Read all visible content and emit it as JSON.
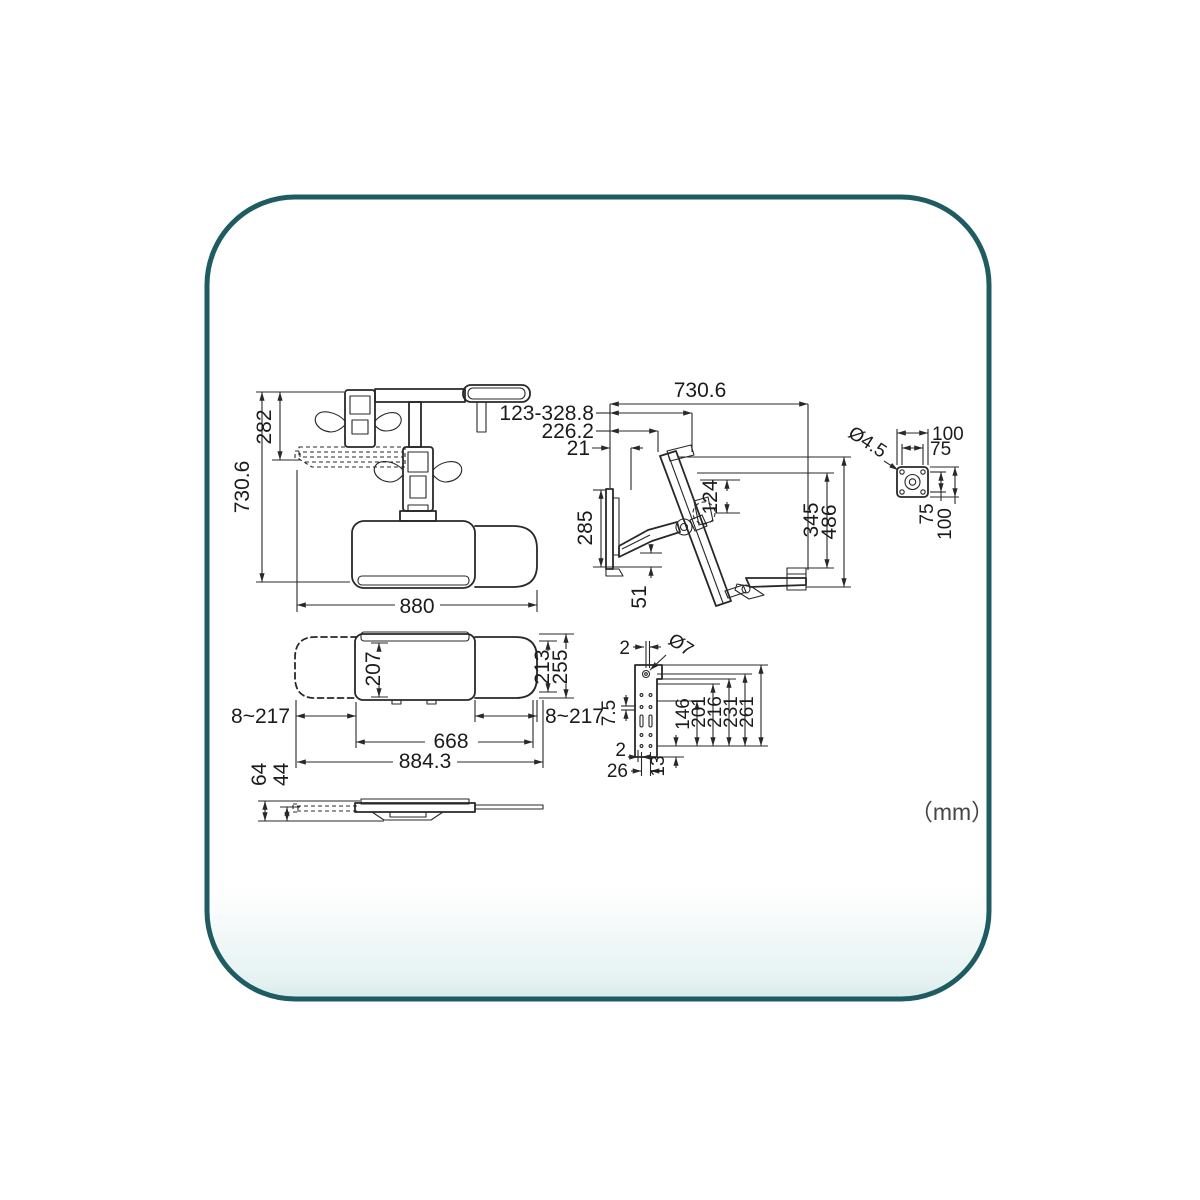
{
  "page": {
    "units_label": "（mm）"
  },
  "colors": {
    "border": "#1e5c61",
    "line": "#282828",
    "fade": "#d7eaea"
  },
  "views": {
    "top_view": {
      "dims": {
        "height_upper": "282",
        "height_total": "730.6",
        "width_total": "880"
      }
    },
    "side_view": {
      "dims": {
        "depth_total": "730.6",
        "keyboard_travel": "123-328.8",
        "arm_reach": "226.2",
        "wall_gap": "21",
        "wall_plate_height": "285",
        "arm_clearance": "51",
        "vesa_offset": "124",
        "monitor_drop": "345",
        "total_drop": "486"
      }
    },
    "vesa_plate": {
      "dims": {
        "hole_diameter": "Ø4.5",
        "width_outer": "100",
        "width_inner": "75",
        "height_inner": "75",
        "height_outer": "100"
      }
    },
    "tray_top": {
      "dims": {
        "keyboard_depth": "207",
        "mouse_tray_depth": "213",
        "total_depth": "255",
        "slide_range_left": "8~217",
        "slide_range_right": "8~217",
        "keyboard_width": "668",
        "total_width": "884.3"
      }
    },
    "tray_front": {
      "dims": {
        "total_thickness": "64",
        "tray_thickness": "44"
      }
    },
    "wall_plate": {
      "dims": {
        "hole_edge_offset_top": "2",
        "hole_diameter": "Ø7",
        "slot_offset": "7.5",
        "height_146": "146",
        "height_201": "201",
        "height_216": "216",
        "height_231": "231",
        "height_261": "261",
        "hole_edge_offset_bottom": "2",
        "hole_spacing_bottom": "26",
        "bottom_hole_offset": "13"
      }
    }
  }
}
